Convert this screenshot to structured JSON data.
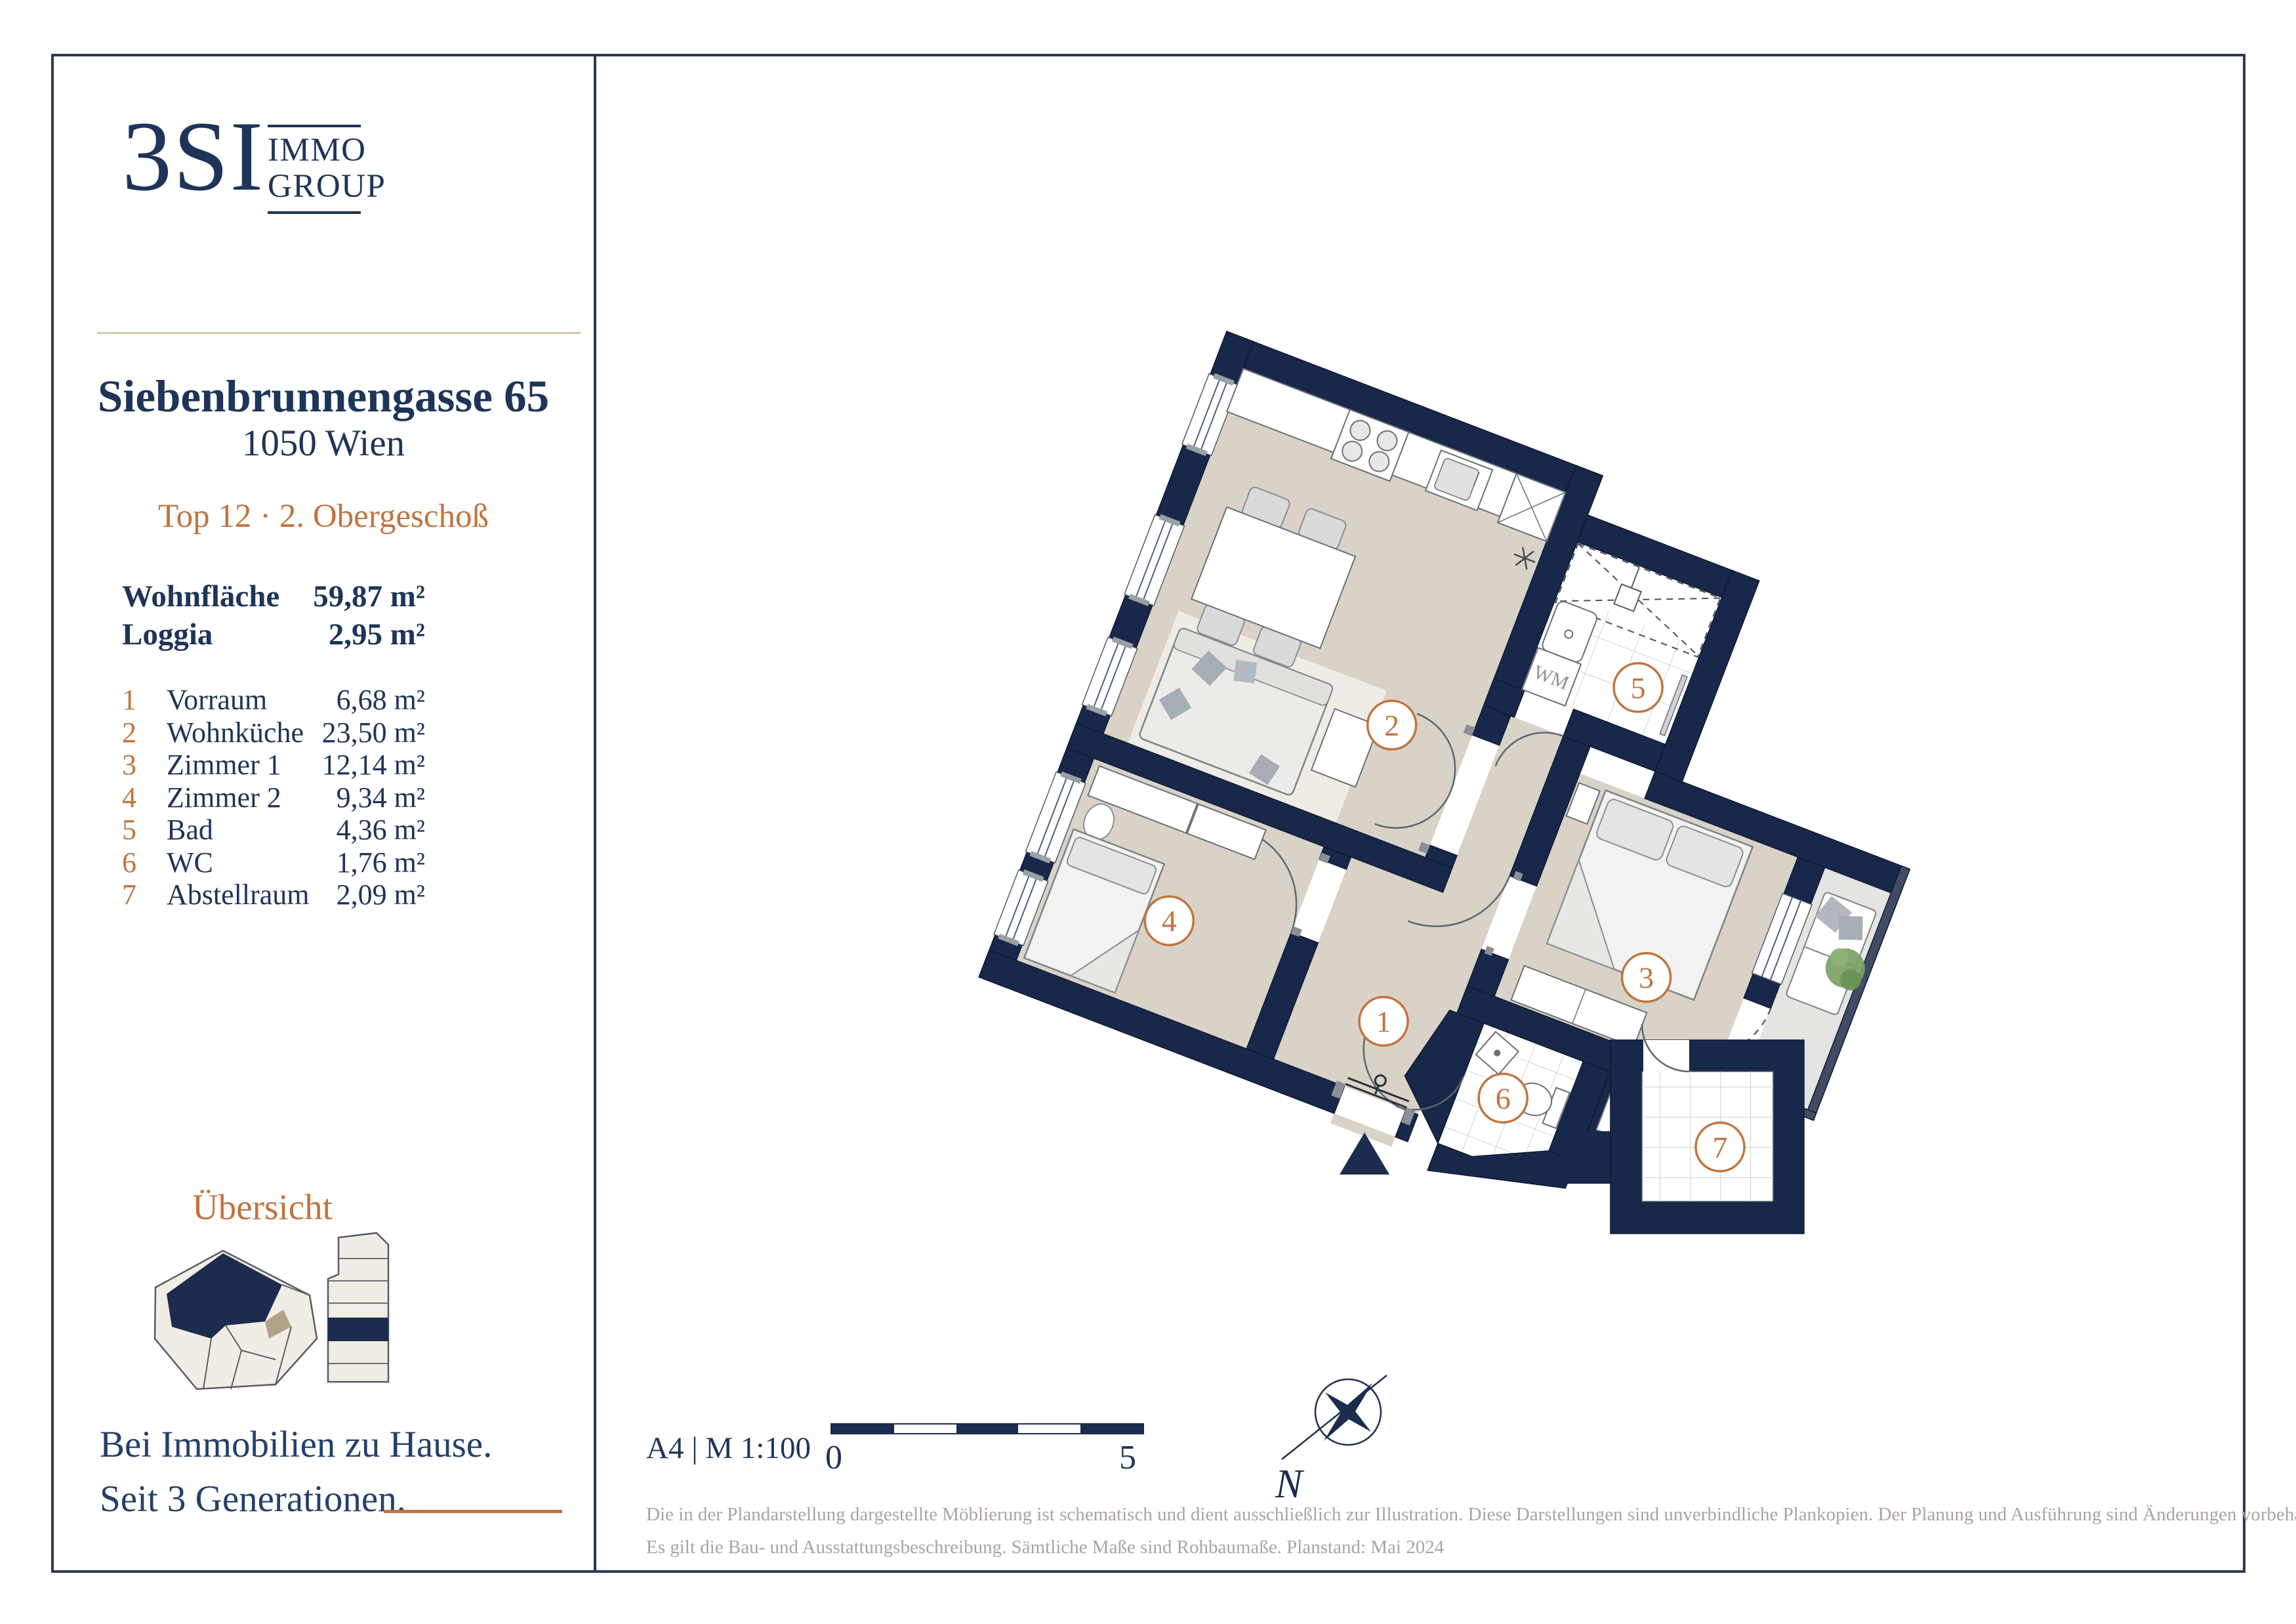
{
  "brand": {
    "logo_text": "3SI",
    "logo_sub1": "IMMO",
    "logo_sub2": "GROUP",
    "tagline_line1": "Bei Immobilien zu Hause.",
    "tagline_line2": "Seit 3 Generationen."
  },
  "header": {
    "address": "Siebenbrunnengasse 65",
    "city": "1050 Wien",
    "unit": "Top 12 · 2. Obergeschoß"
  },
  "areas": {
    "summary": [
      {
        "label": "Wohnfläche",
        "value": "59,87 m²"
      },
      {
        "label": "Loggia",
        "value": "2,95 m²"
      }
    ],
    "rooms": [
      {
        "nr": "1",
        "name": "Vorraum",
        "value": "6,68 m²"
      },
      {
        "nr": "2",
        "name": "Wohnküche",
        "value": "23,50 m²"
      },
      {
        "nr": "3",
        "name": "Zimmer 1",
        "value": "12,14 m²"
      },
      {
        "nr": "4",
        "name": "Zimmer 2",
        "value": "9,34 m²"
      },
      {
        "nr": "5",
        "name": "Bad",
        "value": "4,36 m²"
      },
      {
        "nr": "6",
        "name": "WC",
        "value": "1,76 m²"
      },
      {
        "nr": "7",
        "name": "Abstellraum",
        "value": "2,09 m²"
      }
    ]
  },
  "overview": {
    "title": "Übersicht"
  },
  "plan": {
    "wm_label": "WM",
    "compass_n": "N"
  },
  "footer": {
    "format_scale": "A4 | M 1:100",
    "scale_start": "0",
    "scale_end": "5",
    "disclaimer_line1": "Die in der Plandarstellung dargestellte Möblierung ist schematisch und dient ausschließlich zur Illustration. Diese Darstellungen sind unverbindliche Plankopien. Der Planung und Ausführung sind Änderungen vorbehalten.",
    "disclaimer_line2": "Es gilt die Bau- und Ausstattungsbeschreibung. Sämtliche Maße sind Rohbaumaße. Planstand: Mai 2024"
  },
  "colors": {
    "navy": "#1b2c4e",
    "orange": "#c1743e",
    "floor": "#d9d2c7",
    "tan": "#d9c9ac"
  }
}
